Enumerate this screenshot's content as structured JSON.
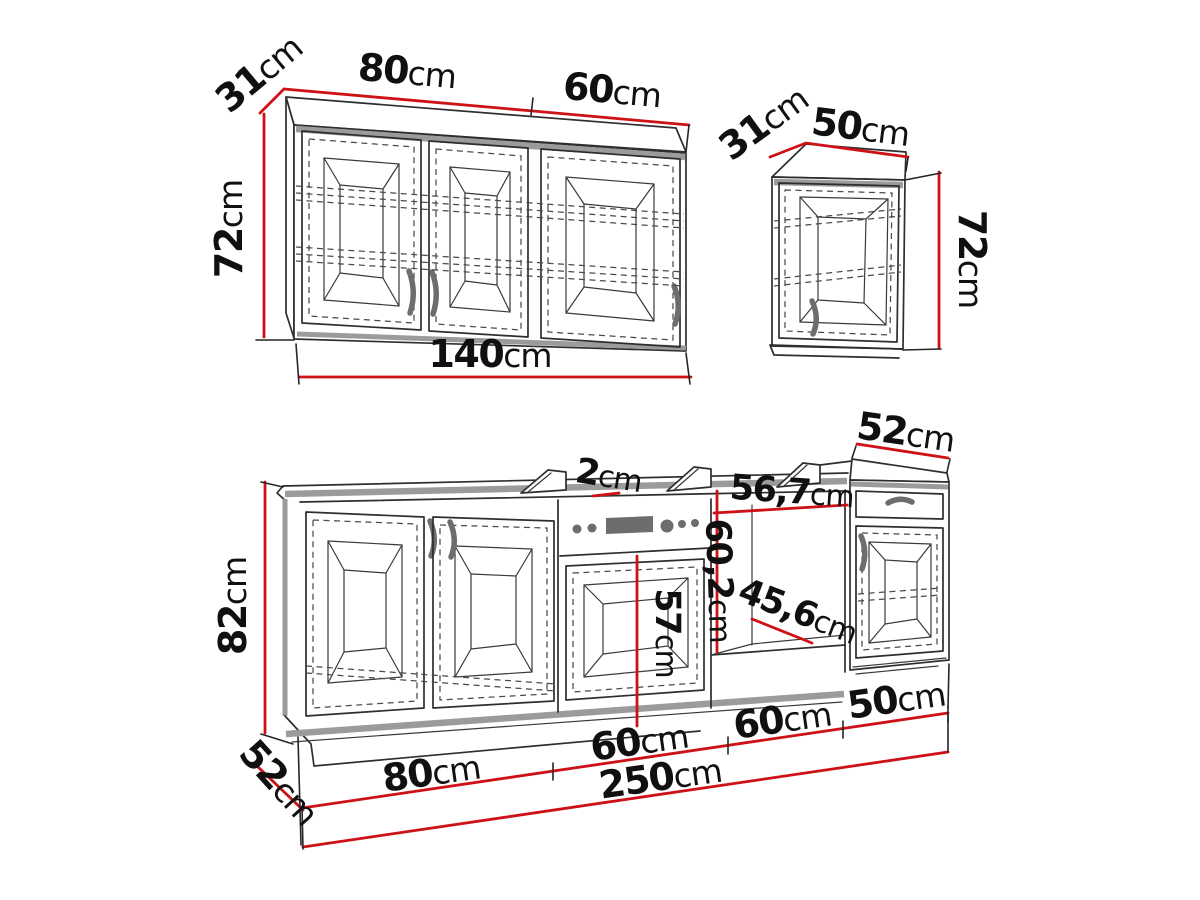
{
  "diagram_title": "Kitchen cabinet set dimension drawing",
  "colors": {
    "dimension_line": "#ce1117",
    "outline": "#2e2e2e",
    "thick_edge": "#9b9b9b",
    "hardware": "#6d6d6d",
    "background": "#ffffff"
  },
  "wall_cabinet_140": {
    "depth_label": {
      "num": "31",
      "unit": "cm"
    },
    "left_section_width_label": {
      "num": "80",
      "unit": "cm"
    },
    "right_section_width_label": {
      "num": "60",
      "unit": "cm"
    },
    "height_label": {
      "num": "72",
      "unit": "cm"
    },
    "total_width_label": {
      "num": "140",
      "unit": "cm"
    }
  },
  "wall_cabinet_50": {
    "depth_label": {
      "num": "31",
      "unit": "cm"
    },
    "width_label": {
      "num": "50",
      "unit": "cm"
    },
    "height_label": {
      "num": "72",
      "unit": "cm"
    }
  },
  "base_run": {
    "height_label": {
      "num": "82",
      "unit": "cm"
    },
    "depth_label": {
      "num": "52",
      "unit": "cm"
    },
    "worktop_thickness_label": {
      "num": "2",
      "unit": "cm"
    },
    "right_cabinet_depth_label": {
      "num": "52",
      "unit": "cm"
    },
    "oven_door_height_label": {
      "num": "57",
      "unit": "cm"
    },
    "niche_width_label": {
      "num": "56,7",
      "unit": "cm"
    },
    "niche_height_label": {
      "num": "60,2",
      "unit": "cm"
    },
    "niche_depth_label": {
      "num": "45,6",
      "unit": "cm"
    },
    "section_width_labels": [
      {
        "num": "80",
        "unit": "cm"
      },
      {
        "num": "60",
        "unit": "cm"
      },
      {
        "num": "60",
        "unit": "cm"
      },
      {
        "num": "50",
        "unit": "cm"
      }
    ],
    "total_width_label": {
      "num": "250",
      "unit": "cm"
    }
  }
}
